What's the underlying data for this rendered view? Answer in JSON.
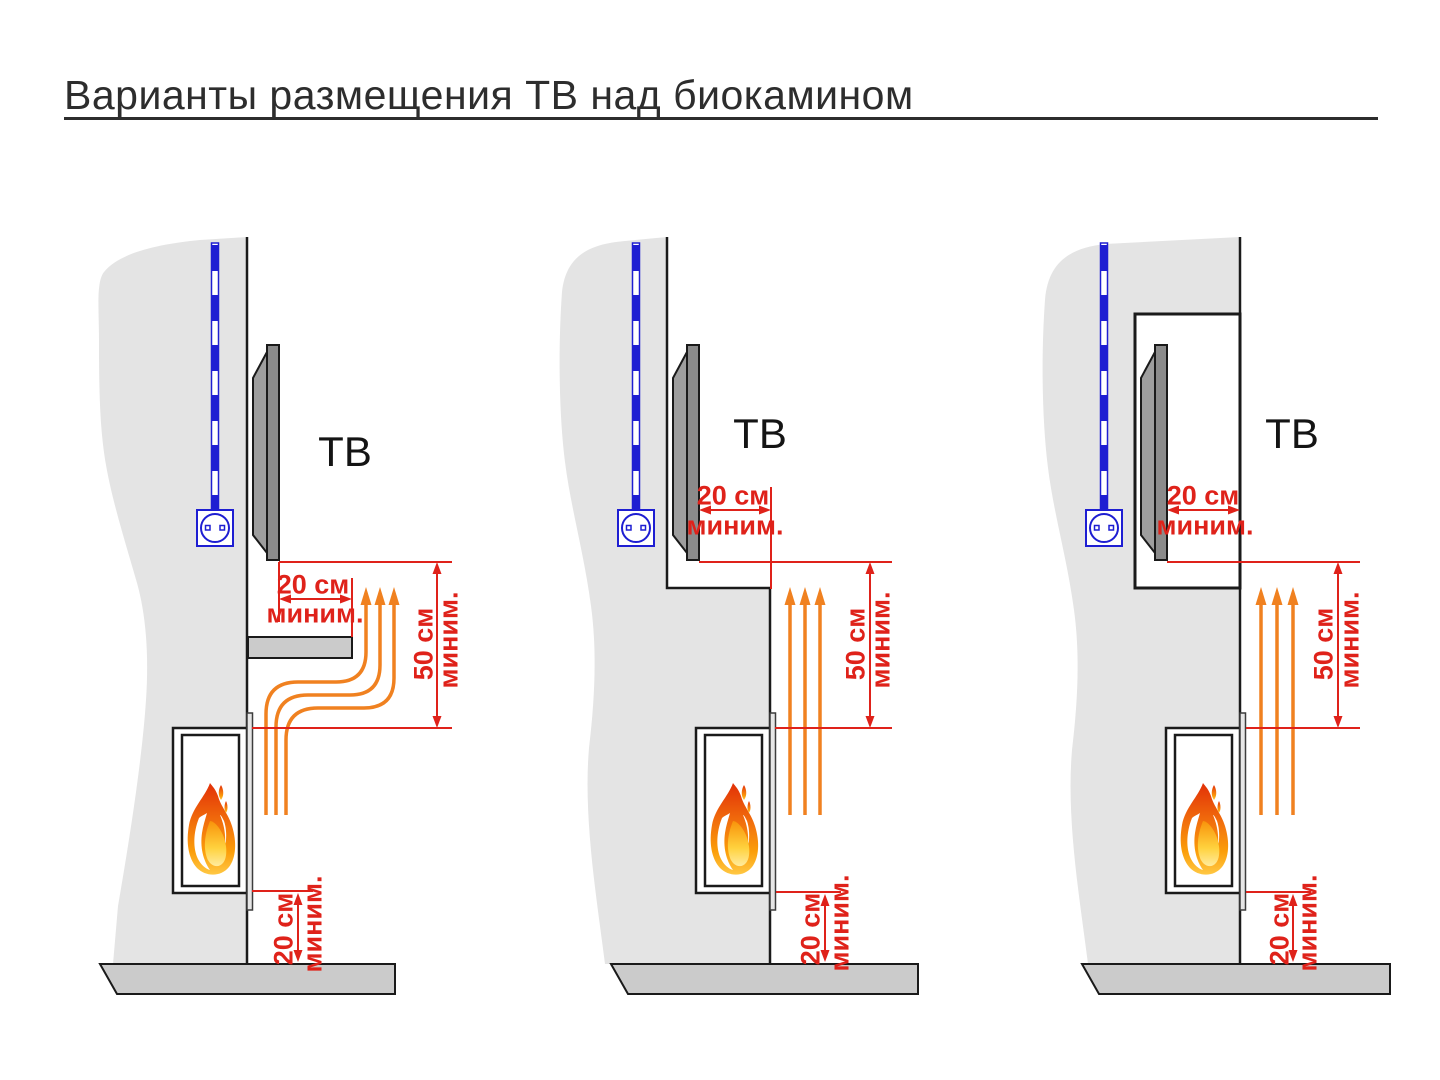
{
  "title": "Варианты размещения ТВ над биокамином",
  "colors": {
    "dimension_red": "#df221a",
    "heat_orange": "#f08120",
    "cable_blue": "#1e1ed2",
    "wall_gray": "#e4e4e4",
    "floor_gray": "#cbcbcb",
    "tv_dark_gray": "#8b8b8b",
    "outline_black": "#1a1a1a"
  },
  "diagrams": [
    {
      "tv_label": "ТВ",
      "tv_gap": {
        "value": "20 см",
        "qualifier": "миним."
      },
      "heat_clearance": {
        "value": "50 см",
        "qualifier": "миним."
      },
      "floor_clearance": {
        "value": "20 см",
        "qualifier": "миним."
      }
    },
    {
      "tv_label": "ТВ",
      "tv_gap": {
        "value": "20 см",
        "qualifier": "миним."
      },
      "heat_clearance": {
        "value": "50 см",
        "qualifier": "миним."
      },
      "floor_clearance": {
        "value": "20 см",
        "qualifier": "миним."
      }
    },
    {
      "tv_label": "ТВ",
      "tv_gap": {
        "value": "20 см",
        "qualifier": "миним."
      },
      "heat_clearance": {
        "value": "50 см",
        "qualifier": "миним."
      },
      "floor_clearance": {
        "value": "20 см",
        "qualifier": "миним."
      }
    }
  ]
}
